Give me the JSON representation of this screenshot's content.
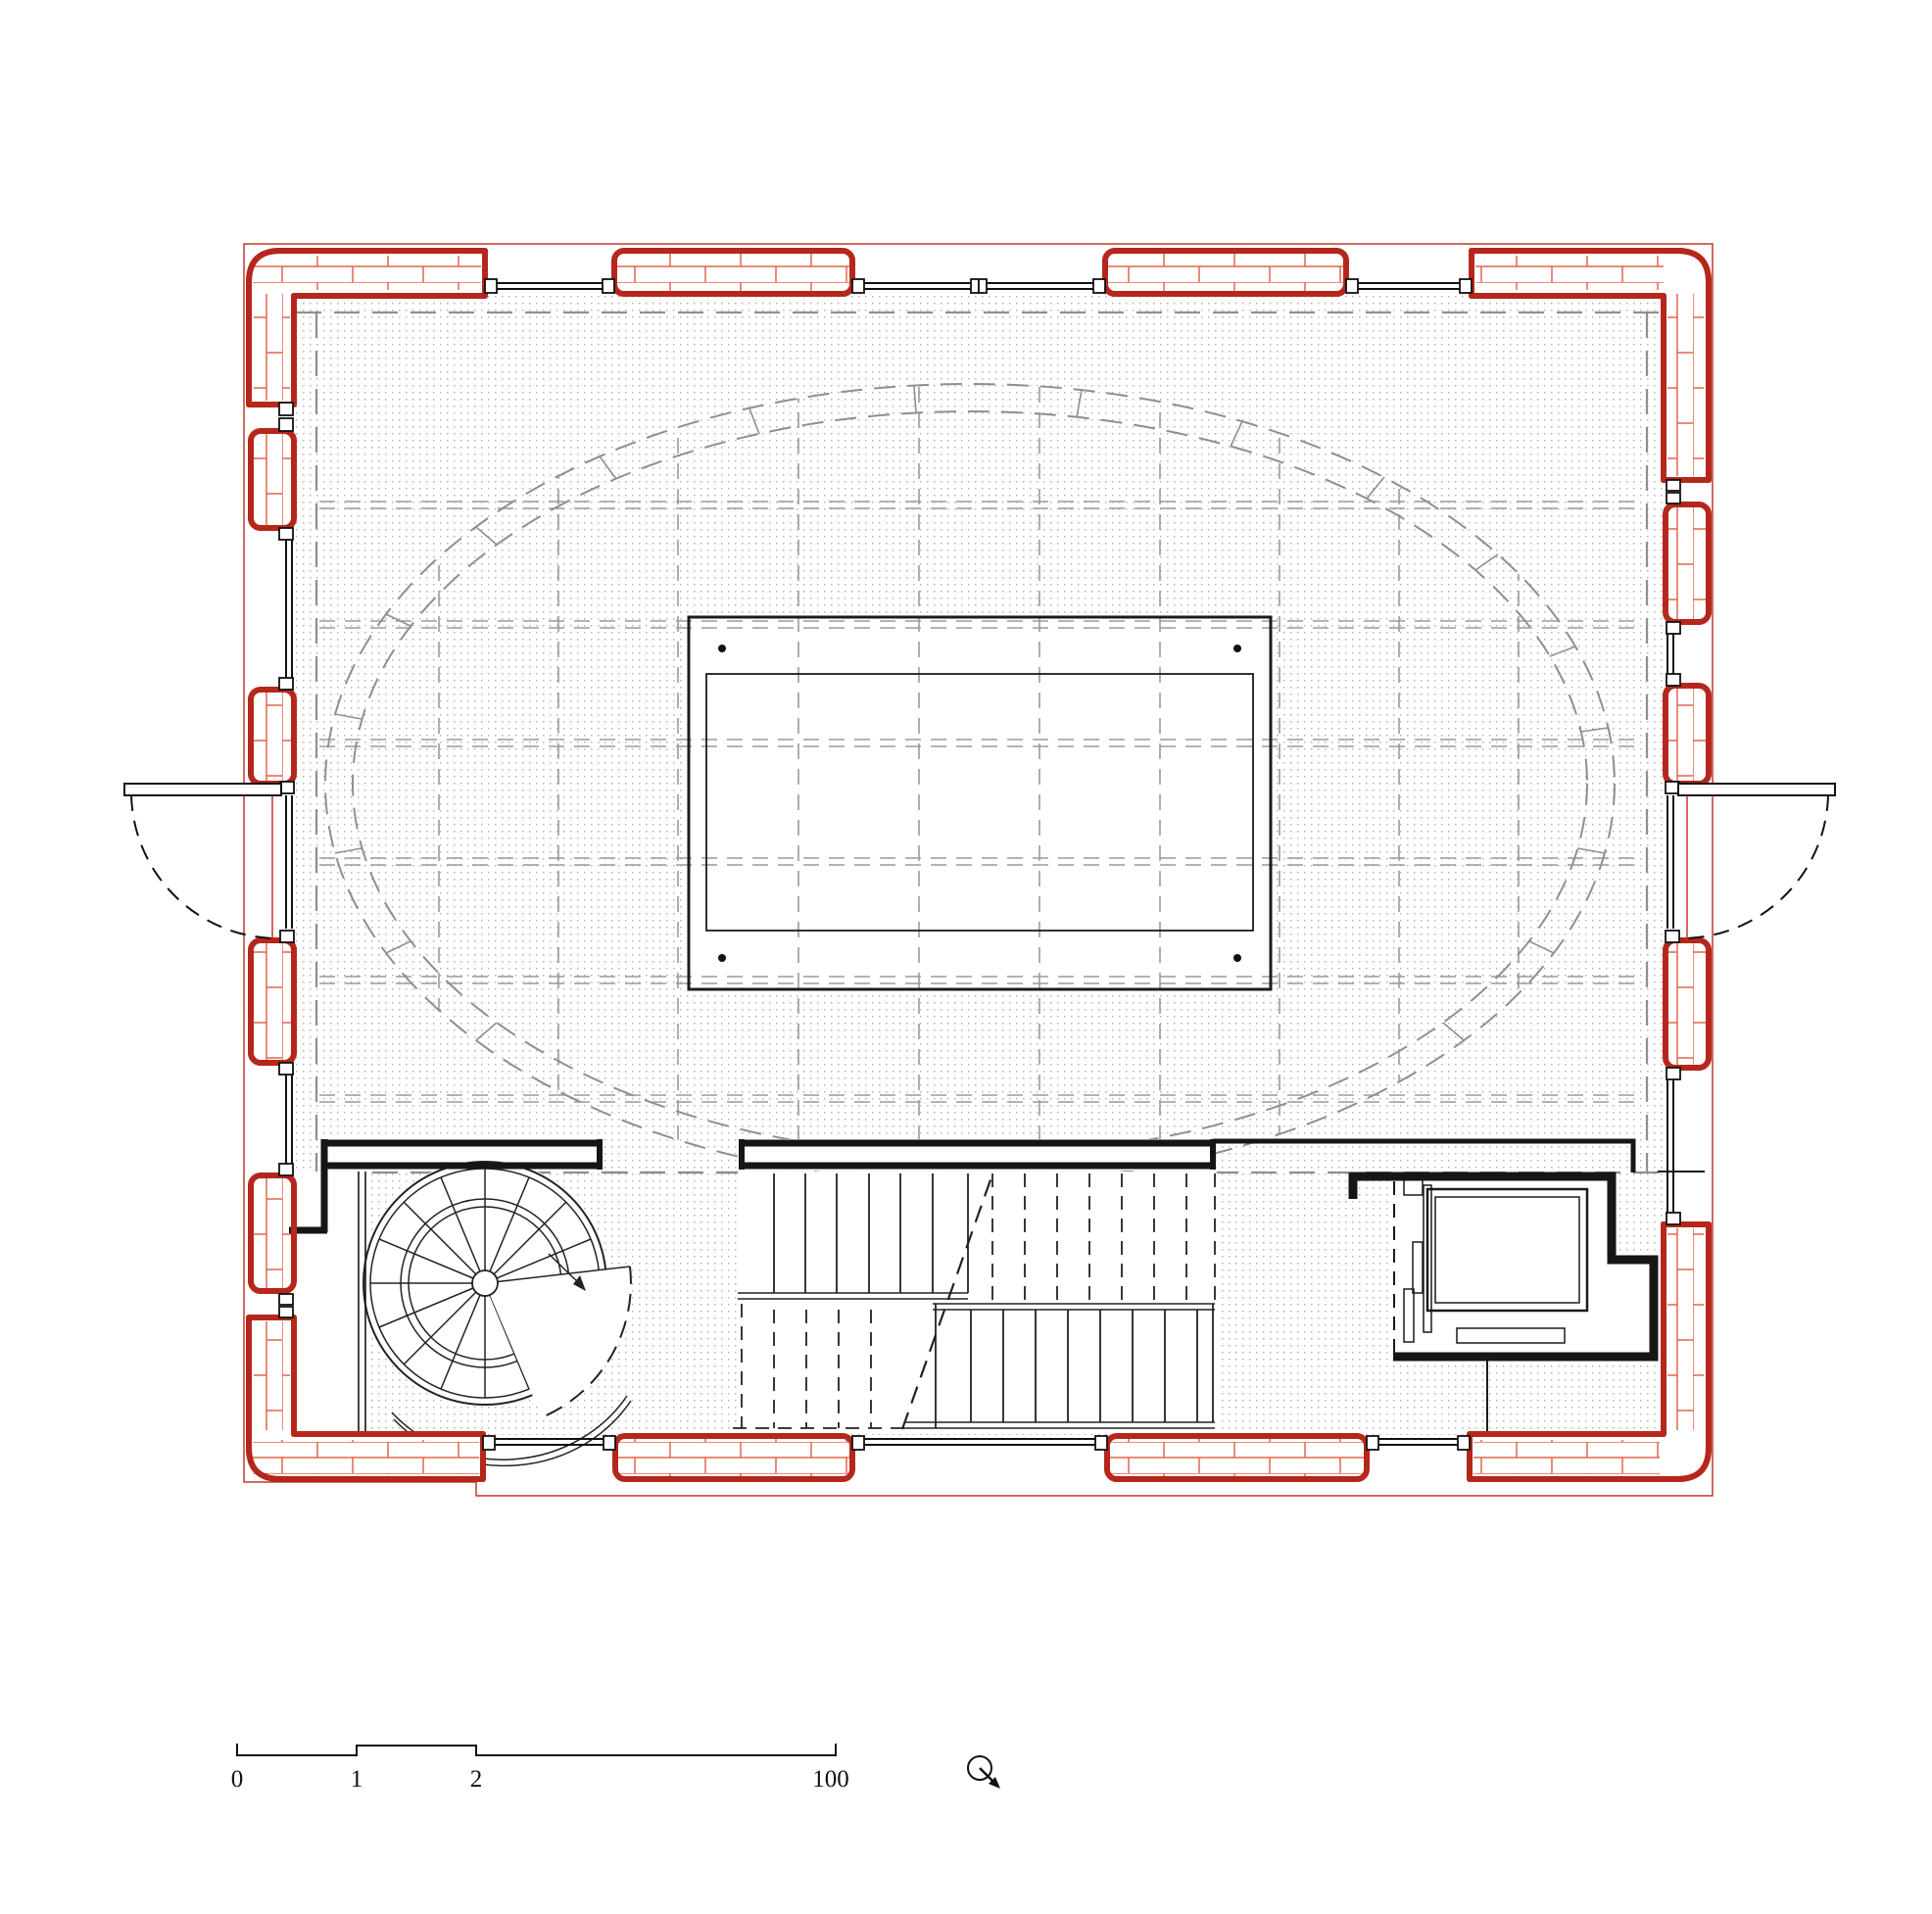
{
  "drawing": {
    "type": "architectural-floor-plan",
    "description": "Upper level floor plan of a rectangular brick building with central skylight, vaulted ceiling shown dashed overhead, spiral stair, switchback stair and elevator along the south side",
    "rooms": [
      "main-hall",
      "spiral-stair",
      "main-stair",
      "elevator",
      "stair-lobby"
    ],
    "wall_construction": "brick",
    "overhead_elements": [
      "vault-rib-ellipse",
      "ceiling-grid",
      "gallery-edge"
    ]
  },
  "scale_bar": {
    "labels": {
      "zero": "0",
      "one": "1",
      "two": "2",
      "hundred": "100"
    }
  },
  "north_symbol": "circle-with-arrow",
  "colors": {
    "wall_red": "#b5271c",
    "brick_hatch": "#e0664d",
    "line_black": "#1a1a1a",
    "overhead_gray": "#8f8f8f",
    "stipple_dot": "#b3b3b3",
    "page_bg": "#ffffff"
  }
}
